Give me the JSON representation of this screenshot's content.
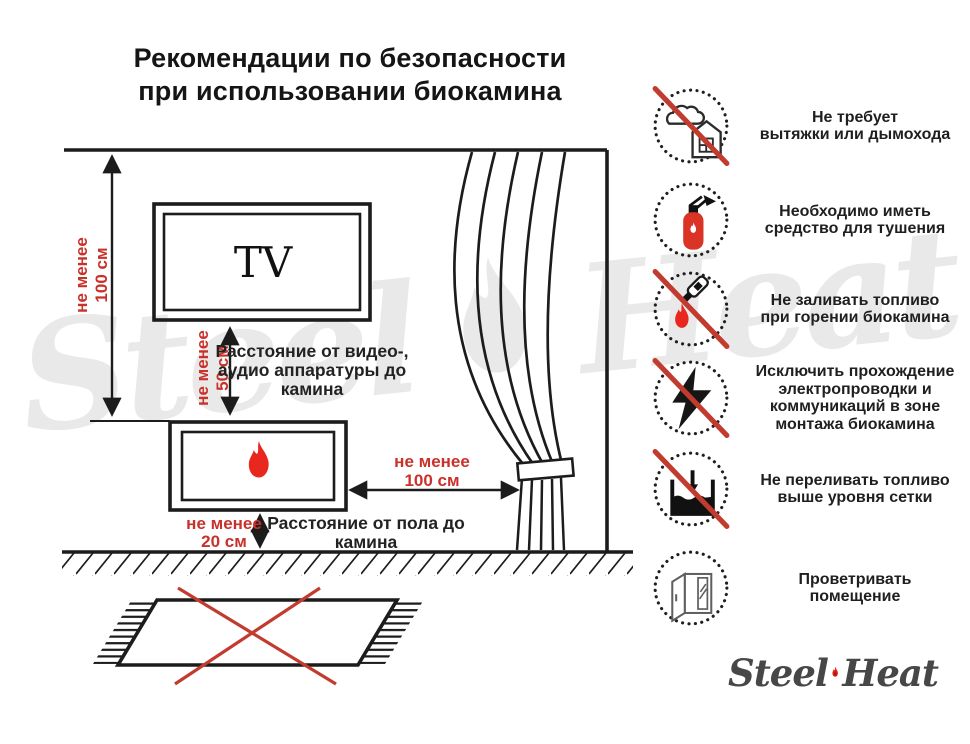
{
  "title": {
    "line1": "Рекомендации по безопасности",
    "line2": "при использовании биокамина"
  },
  "diagram": {
    "tv_label": "TV",
    "dim_wall": {
      "l1": "не менее",
      "l2": "100 см"
    },
    "dim_tv": {
      "l1": "не менее",
      "l2": "50 см"
    },
    "dim_curtain": {
      "l1": "не менее",
      "l2": "100 см"
    },
    "dim_floor": {
      "l1": "не менее",
      "l2": "20 см"
    },
    "caption_av": {
      "l1": "Расстояние от видео-,",
      "l2": "аудио аппаратуры до",
      "l3": "камина"
    },
    "caption_floor": {
      "l1": "Расстояние от пола до",
      "l2": "камина"
    }
  },
  "recommendations": [
    {
      "icon": "no-chimney-icon",
      "crossed": true,
      "lines": [
        "Не требует",
        "вытяжки или дымохода"
      ]
    },
    {
      "icon": "extinguisher-icon",
      "crossed": false,
      "lines": [
        "Необходимо иметь",
        "средство для тушения"
      ]
    },
    {
      "icon": "no-refuel-while-burning-icon",
      "crossed": true,
      "lines": [
        "Не заливать топливо",
        "при горении биокамина"
      ]
    },
    {
      "icon": "no-wiring-icon",
      "crossed": true,
      "lines": [
        "Исключить прохождение",
        "электропроводки и",
        "коммуникаций в зоне",
        "монтажа биокамина"
      ]
    },
    {
      "icon": "no-overfill-icon",
      "crossed": true,
      "lines": [
        "Не переливать топливо",
        "выше уровня сетки"
      ]
    },
    {
      "icon": "ventilate-icon",
      "crossed": false,
      "lines": [
        "Проветривать",
        "помещение"
      ]
    }
  ],
  "watermark": {
    "word1": "Steel",
    "word2": "Heat"
  },
  "logo": {
    "word1": "Steel",
    "word2": "Heat"
  },
  "colors": {
    "accent_red": "#c9312b",
    "flame_red": "#e8281e",
    "cross_red": "#c23b2f",
    "line_black": "#1c1c1c"
  }
}
